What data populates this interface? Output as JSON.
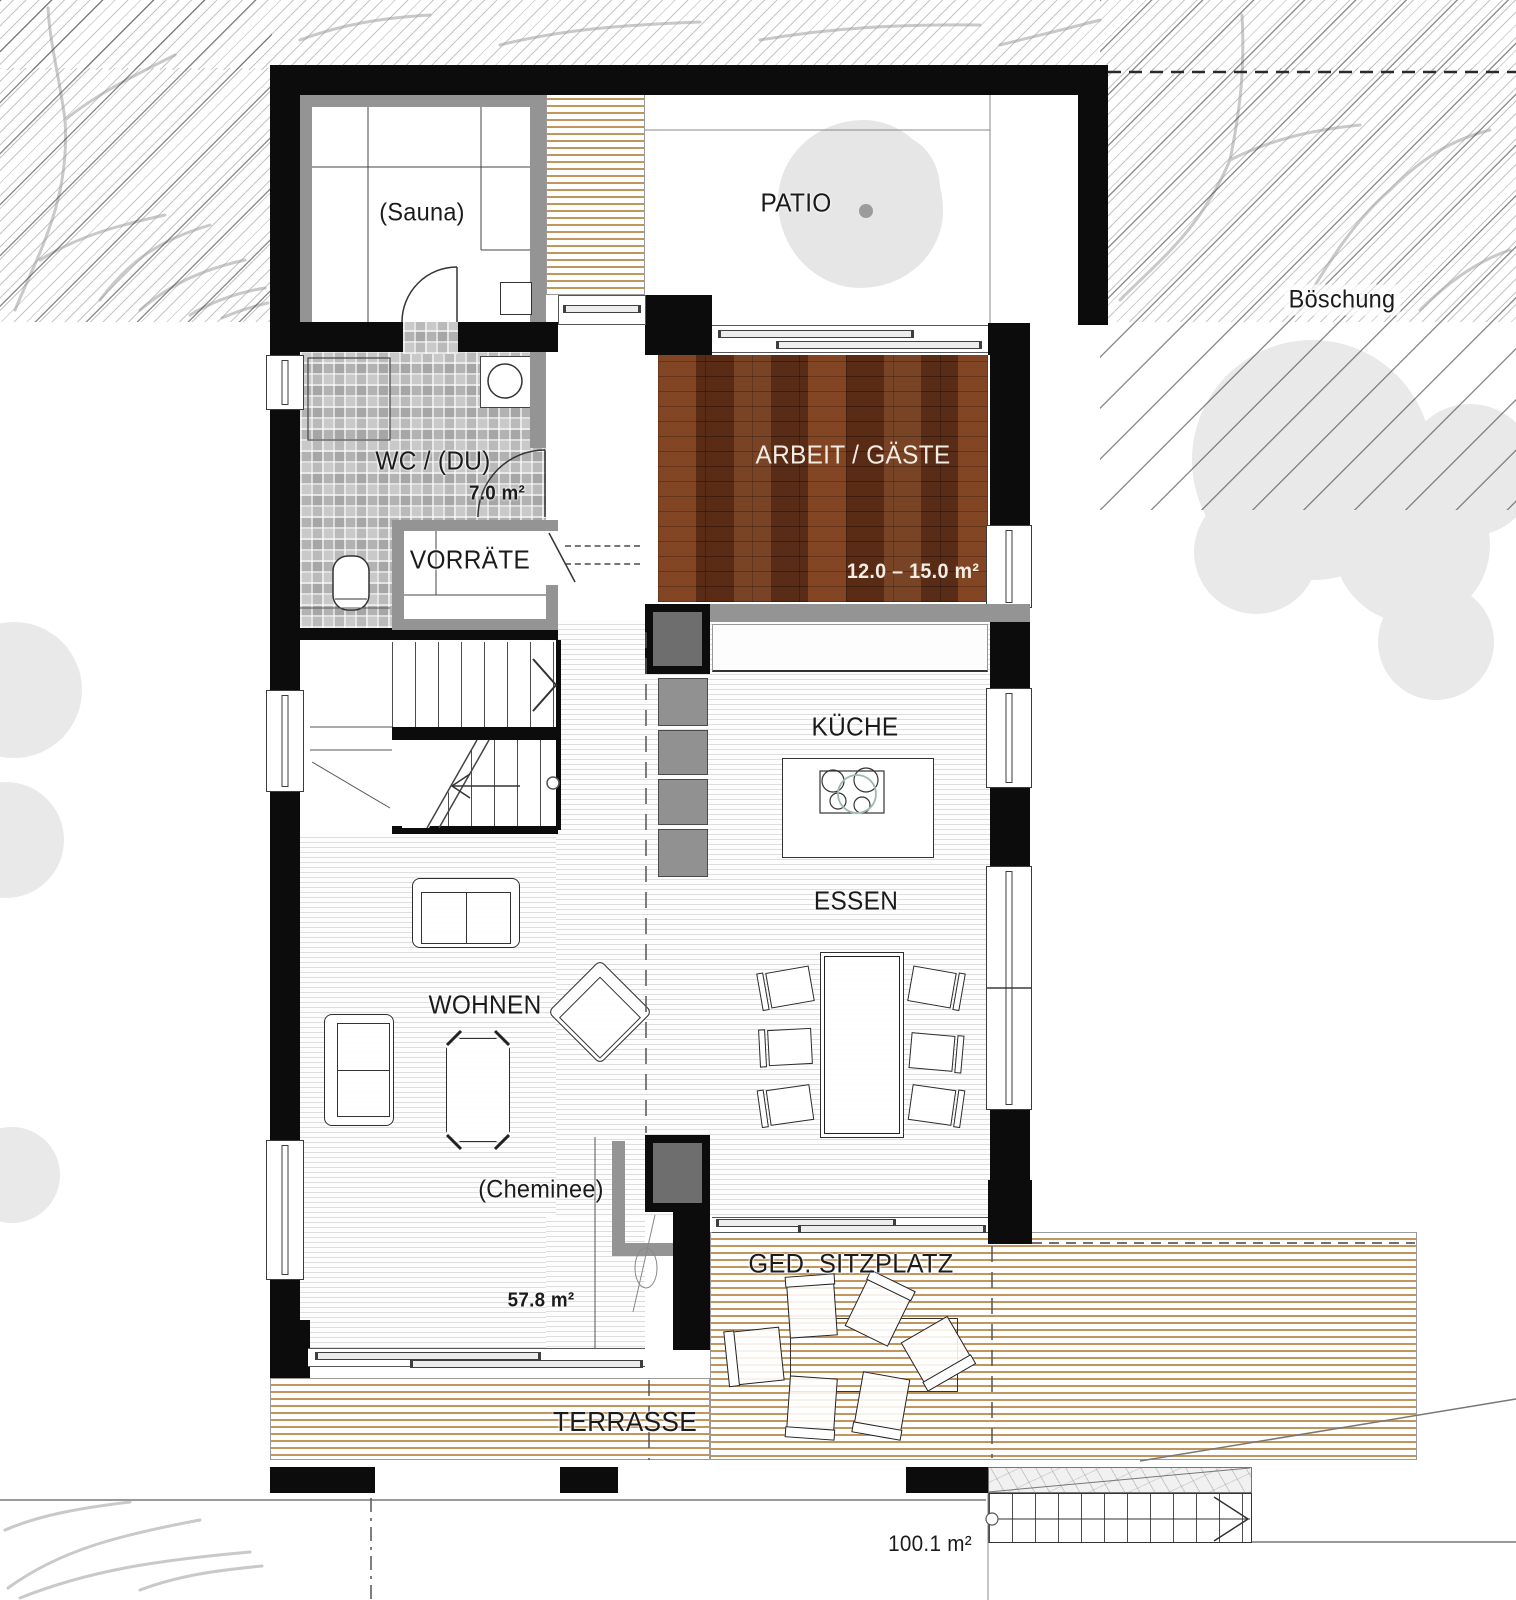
{
  "plan": {
    "site": {
      "boeschung_label": "Böschung",
      "site_area": "100.1 m²"
    },
    "rooms": [
      {
        "id": "sauna",
        "label": "(Sauna)"
      },
      {
        "id": "patio",
        "label": "PATIO"
      },
      {
        "id": "wc_du",
        "label": "WC / (DU)",
        "area": "7.0 m²"
      },
      {
        "id": "vorraete",
        "label": "VORRÄTE"
      },
      {
        "id": "arbeit_gaeste",
        "label": "ARBEIT / GÄSTE",
        "area": "12.0 – 15.0 m²"
      },
      {
        "id": "kueche",
        "label": "KÜCHE"
      },
      {
        "id": "essen",
        "label": "ESSEN"
      },
      {
        "id": "wohnen",
        "label": "WOHNEN",
        "area": "57.8 m²"
      },
      {
        "id": "cheminee",
        "label": "(Cheminee)"
      },
      {
        "id": "ged_sitzplatz",
        "label": "GED. SITZPLATZ"
      },
      {
        "id": "terrasse",
        "label": "TERRASSE"
      }
    ],
    "colors": {
      "wall": "#0c0c0c",
      "parquet_floor": "#6a341b",
      "deck_board_line": "#c2955d",
      "tile_floor": "#c9c9c9",
      "interior_floor_line": "#dedede",
      "vegetation": "#e9e9e9"
    }
  }
}
